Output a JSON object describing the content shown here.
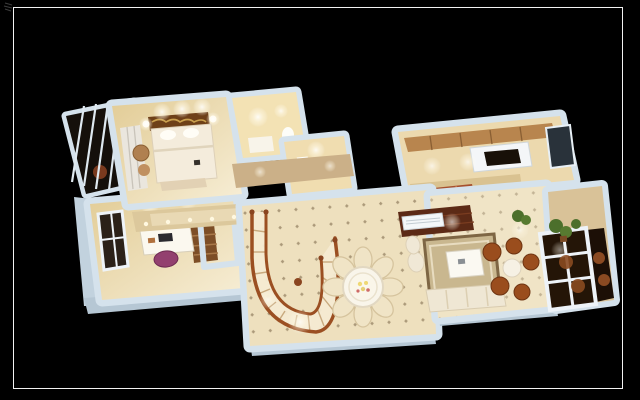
{
  "scene": {
    "kind": "3d-dollhouse-floorplan-render",
    "description": "Top-down 3D architectural render of an apartment interior floating on a black background inside a thin white frame",
    "rooms": [
      {
        "name": "enclosed-balcony-left"
      },
      {
        "name": "master-bedroom"
      },
      {
        "name": "bathroom"
      },
      {
        "name": "wc"
      },
      {
        "name": "hallway"
      },
      {
        "name": "kitchen"
      },
      {
        "name": "study"
      },
      {
        "name": "stair-hall"
      },
      {
        "name": "dining-area"
      },
      {
        "name": "living-room"
      },
      {
        "name": "sunroom-balcony-right"
      }
    ],
    "furniture": [
      "double-bed",
      "wardrobe",
      "armchair",
      "vanity",
      "toilet",
      "sink",
      "range-hood",
      "cooktop",
      "desk",
      "laptop",
      "office-chair",
      "bookshelf",
      "spiral-staircase",
      "round-dining-table",
      "dining-chairs",
      "area-rug",
      "coffee-table",
      "sofa",
      "tv-floor-strip",
      "media-unit",
      "glass-doors",
      "wicker-chairs",
      "wicker-table",
      "potted-plants"
    ],
    "lighting": "warm recessed ceiling spots glowing in every room"
  },
  "palette": {
    "background": "#000000",
    "frame_line": "#f2f2f2",
    "wall": "#d5e2ec",
    "wall_side": "#b6c7d4",
    "floor_warm": "#ecd9ae",
    "floor_light": "#f0e4c6",
    "rug": "#c9b78f",
    "wood_dark": "#5c2a16",
    "wood_red": "#a6502e",
    "stair_rail": "#9b4f22",
    "chair_purple": "#93406f",
    "plant_green": "#4c6f2b",
    "wicker_brown": "#9a4d1d",
    "glow": "#ffffff"
  }
}
